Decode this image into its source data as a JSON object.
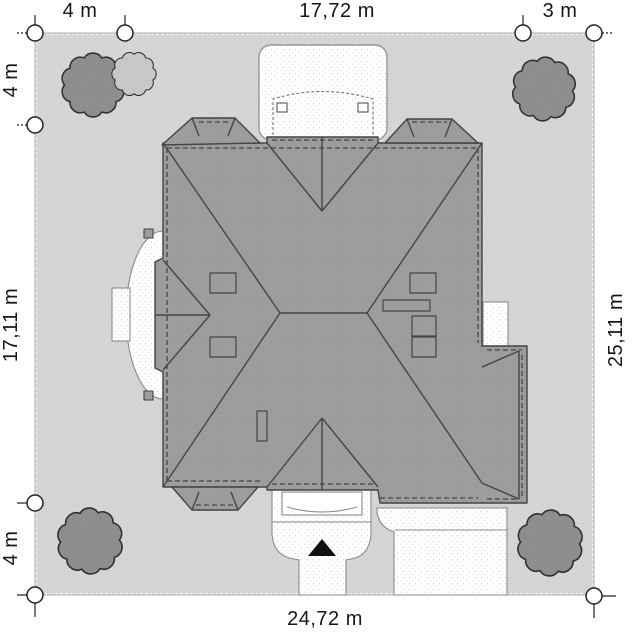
{
  "dimensions": {
    "top": [
      {
        "label": "4 m"
      },
      {
        "label": "17,72 m"
      },
      {
        "label": "3 m"
      }
    ],
    "left": [
      {
        "label": "4 m"
      },
      {
        "label": "17,11 m"
      },
      {
        "label": "4 m"
      }
    ],
    "right": [
      {
        "label": "25,11 m"
      }
    ],
    "bottom": [
      {
        "label": "24,72 m"
      }
    ]
  },
  "icons": {
    "entrance_marker": "black-triangle",
    "tree": "scalloped-circle",
    "dimension_marker": "circle-with-tick"
  },
  "colors": {
    "plot_fill": "#d5d5d5",
    "roof_fill": "#9d9d9d",
    "outline": "#454545",
    "paving_fill": "#ffffff",
    "tree_fill": "#8e8e8e",
    "tree_light_fill": "#c8c8c8",
    "marker_stroke": "#222222",
    "text": "#161616"
  }
}
